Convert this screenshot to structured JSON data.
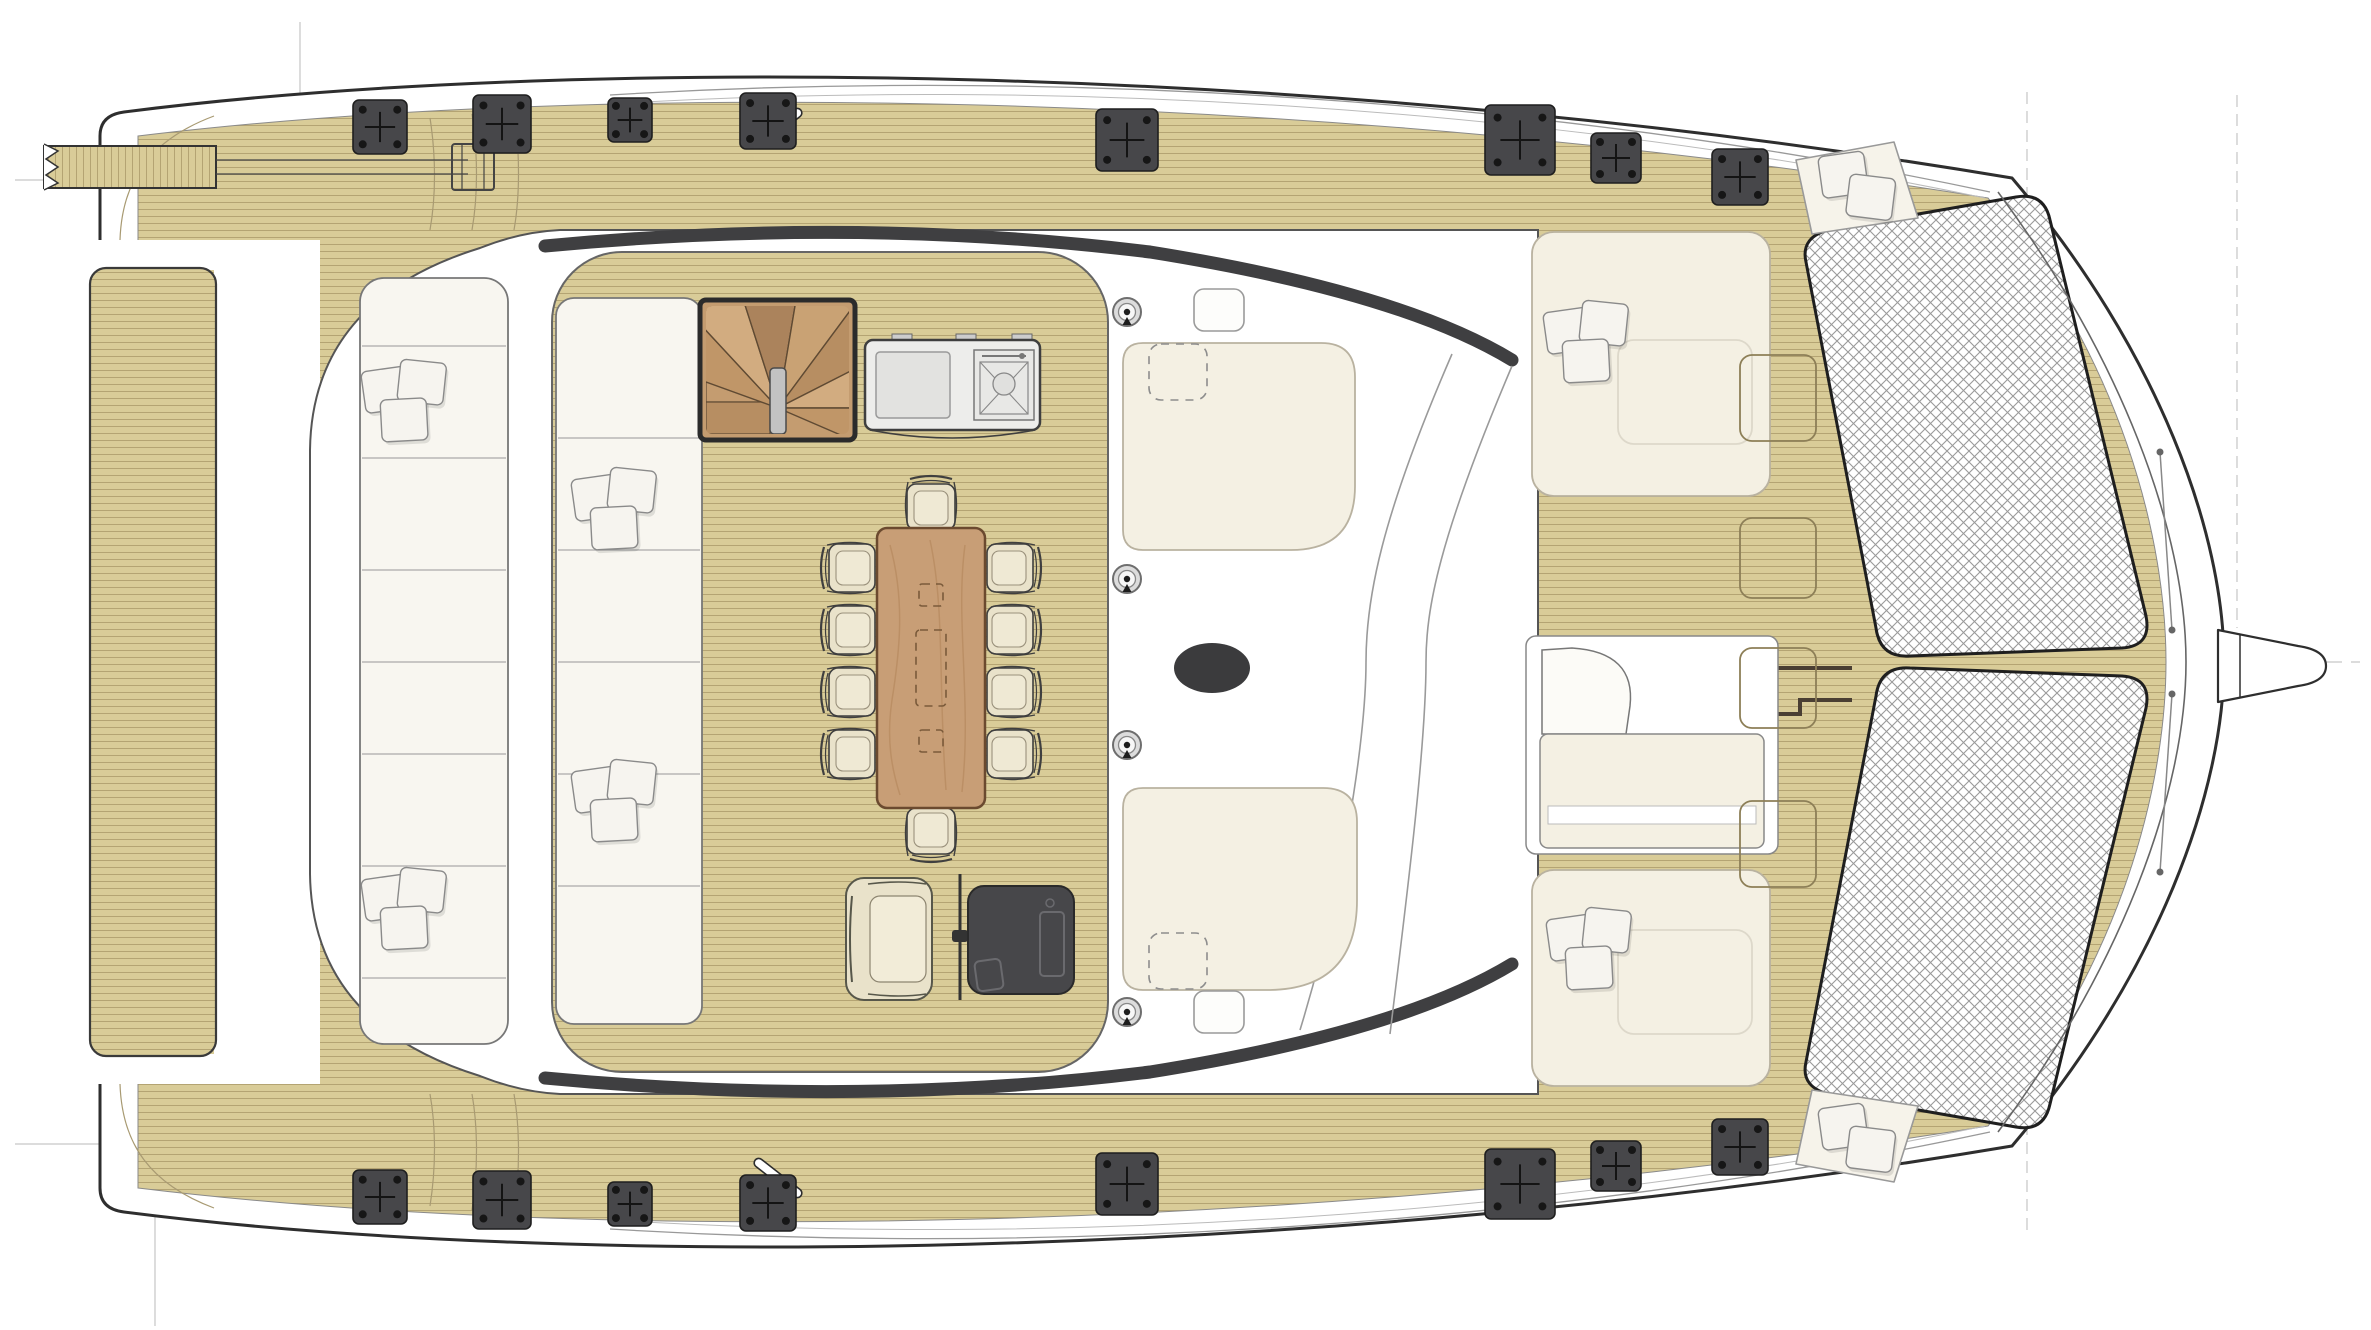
{
  "meta": {
    "drawing_type": "catamaran-flybridge-deck-plan",
    "view": "top-down",
    "visible_text": ""
  },
  "palette": {
    "paper": "#ffffff",
    "outline": "#2e2e2e",
    "soft_outline": "#777777",
    "teak": "#d9cc98",
    "teak_line": "#a08f60",
    "hardware": "#47474a",
    "cream": "#f4f0e3",
    "lounge_white": "#f8f6f0",
    "cushion": "#e9e2ca",
    "wood_table": "#c89e76",
    "wood_dark": "#6e4f33",
    "stair_wood": "#c49c70",
    "net_line": "#9a9a9a",
    "ref_line": "#c6c6c6",
    "windshield": "#3f3f41",
    "mast": "#3b3b3d"
  },
  "deck_hardware": {
    "winch_pads": [
      {
        "x": 380,
        "y": 127,
        "s": 54
      },
      {
        "x": 502,
        "y": 124,
        "s": 58
      },
      {
        "x": 630,
        "y": 120,
        "s": 44
      },
      {
        "x": 768,
        "y": 121,
        "s": 56
      },
      {
        "x": 1127,
        "y": 140,
        "s": 62
      },
      {
        "x": 1520,
        "y": 140,
        "s": 70
      },
      {
        "x": 1616,
        "y": 158,
        "s": 50
      },
      {
        "x": 1740,
        "y": 177,
        "s": 56
      },
      {
        "x": 380,
        "y": 1197,
        "s": 54
      },
      {
        "x": 502,
        "y": 1200,
        "s": 58
      },
      {
        "x": 630,
        "y": 1204,
        "s": 44
      },
      {
        "x": 768,
        "y": 1203,
        "s": 56
      },
      {
        "x": 1127,
        "y": 1184,
        "s": 62
      },
      {
        "x": 1520,
        "y": 1184,
        "s": 70
      },
      {
        "x": 1616,
        "y": 1166,
        "s": 50
      },
      {
        "x": 1740,
        "y": 1147,
        "s": 56
      }
    ],
    "deck_rings": [
      {
        "x": 1127,
        "y": 312
      },
      {
        "x": 1127,
        "y": 579
      },
      {
        "x": 1127,
        "y": 745
      },
      {
        "x": 1127,
        "y": 1012
      }
    ],
    "teak_hatches": [
      {
        "x": 1778,
        "y": 398,
        "w": 76,
        "h": 86
      },
      {
        "x": 1778,
        "y": 558,
        "w": 76,
        "h": 80
      },
      {
        "x": 1778,
        "y": 688,
        "w": 76,
        "h": 80
      },
      {
        "x": 1778,
        "y": 844,
        "w": 76,
        "h": 86
      }
    ],
    "white_hatches": [
      {
        "x": 1219,
        "y": 310,
        "w": 50,
        "h": 42
      },
      {
        "x": 1219,
        "y": 1012,
        "w": 50,
        "h": 42
      }
    ],
    "dashed_hatches": [
      {
        "x": 1178,
        "y": 372,
        "w": 58,
        "h": 56
      },
      {
        "x": 1178,
        "y": 961,
        "w": 58,
        "h": 56
      }
    ]
  },
  "furniture": {
    "dining_table": {
      "x": 877,
      "y": 528,
      "w": 108,
      "h": 280,
      "seats": 10
    },
    "dining_chairs": [
      {
        "x": 851,
        "y": 568,
        "rot": 0
      },
      {
        "x": 851,
        "y": 630,
        "rot": 0
      },
      {
        "x": 851,
        "y": 692,
        "rot": 0
      },
      {
        "x": 851,
        "y": 754,
        "rot": 0
      },
      {
        "x": 1011,
        "y": 568,
        "rot": 180
      },
      {
        "x": 1011,
        "y": 630,
        "rot": 180
      },
      {
        "x": 1011,
        "y": 692,
        "rot": 180
      },
      {
        "x": 1011,
        "y": 754,
        "rot": 180
      },
      {
        "x": 931,
        "y": 506,
        "rot": 90
      },
      {
        "x": 931,
        "y": 832,
        "rot": -90
      }
    ],
    "pillow_clusters": [
      {
        "x": 404,
        "y": 404,
        "count": 3
      },
      {
        "x": 404,
        "y": 912,
        "count": 3
      },
      {
        "x": 614,
        "y": 512,
        "count": 3
      },
      {
        "x": 614,
        "y": 804,
        "count": 3
      },
      {
        "x": 1586,
        "y": 345,
        "count": 3
      },
      {
        "x": 1589,
        "y": 952,
        "count": 3
      },
      {
        "x": 1856,
        "y": 186,
        "count": 2
      },
      {
        "x": 1856,
        "y": 1138,
        "count": 2
      }
    ]
  }
}
